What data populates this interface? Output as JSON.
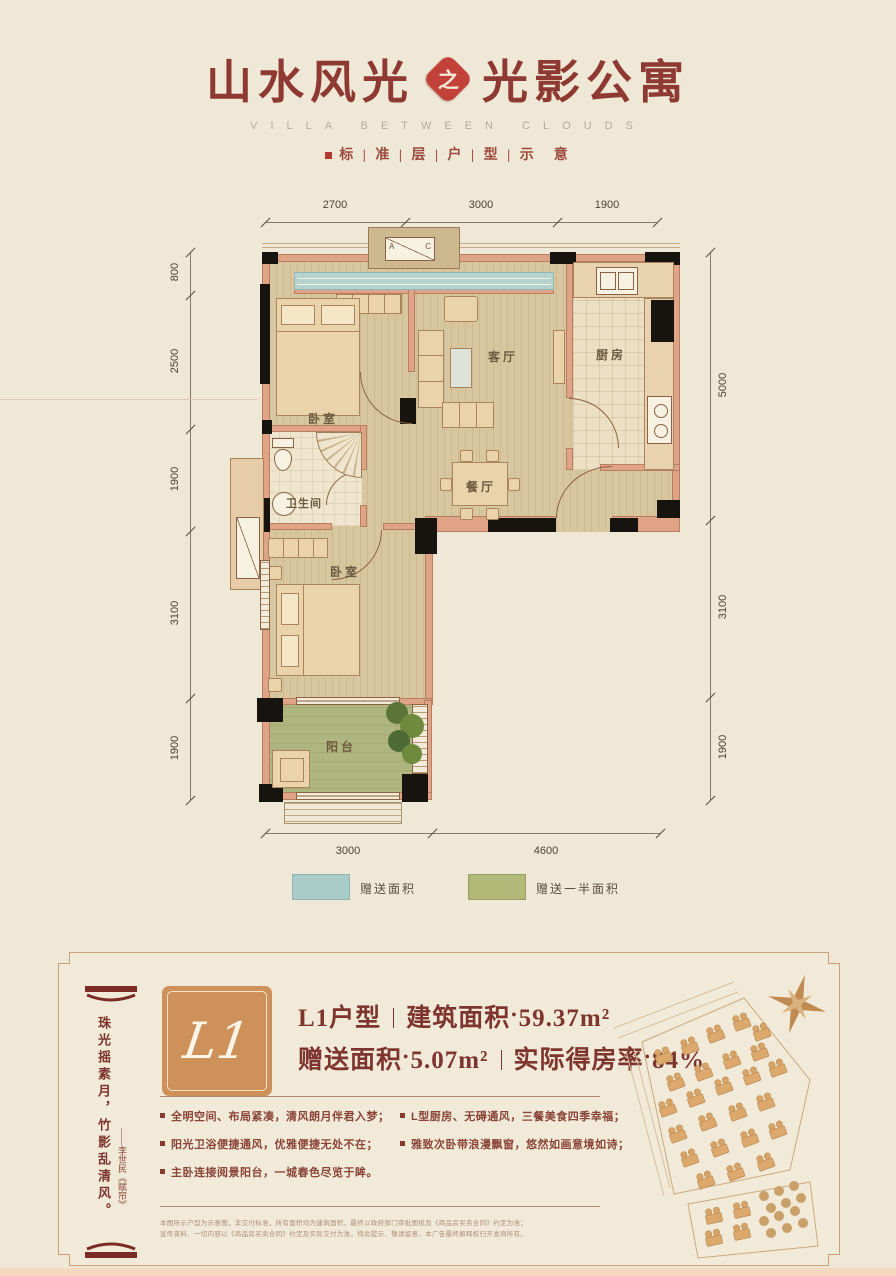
{
  "header": {
    "title_left": "山水风光",
    "title_badge": "之",
    "title_right": "光影公寓",
    "subtitle_en": "VILLA BETWEEN CLOUDS",
    "subtitle_cn": "标 | 准 | 层 | 户 | 型 | 示　意"
  },
  "floorplan": {
    "rooms": {
      "bedroom1": "卧室",
      "living": "客厅",
      "kitchen": "厨房",
      "bath": "卫生间",
      "dining": "餐厅",
      "bedroom2": "卧室",
      "balcony": "阳台"
    },
    "ac_a": "A",
    "ac_c": "C",
    "dims_top": [
      "2700",
      "3000",
      "1900"
    ],
    "dims_bottom": [
      "3000",
      "4600"
    ],
    "dims_left": [
      "800",
      "2500",
      "1900",
      "3100",
      "1900"
    ],
    "dims_right": [
      "5000",
      "3100",
      "1900"
    ]
  },
  "legend": {
    "item1": {
      "label": "赠送面积",
      "color": "#A9CCC9"
    },
    "item2": {
      "label": "赠送一半面积",
      "color": "#B2B878"
    }
  },
  "panel": {
    "badge": "L1",
    "unit_name": "L1户型",
    "approx_dot": "●",
    "build_area_label": "建筑面积",
    "build_area_value": "59.37m²",
    "gift_area_label": "赠送面积",
    "gift_area_value": "5.07m²",
    "rate_label": "实际得房率",
    "rate_value": "84%",
    "bullets": [
      "全明空间、布局紧凑，清风朗月伴君入梦；",
      "L型厨房、无碍通风，三餐美食四季幸福；",
      "阳光卫浴便捷通风，优雅便捷无处不在；",
      "雅致次卧带浪漫飘窗，悠然如画意境如诗；",
      "主卧连接阅景阳台，一城春色尽览于眸。"
    ],
    "poem": "珠光摇素月，竹影乱清风。",
    "poem_attribution": "——李世民《赋帘》",
    "disclaimer_line1": "本图所示户型为示意图，非交付标准，所有面积均为建筑面积，最终以政府部门审批图纸及《商品房买卖合同》约定为准；",
    "disclaimer_line2": "宣传资料、一切内容以《商品房买卖合同》约定及实际交付为准，特此提示、敬请留意，本广告最终解释权归开发商所有。"
  }
}
